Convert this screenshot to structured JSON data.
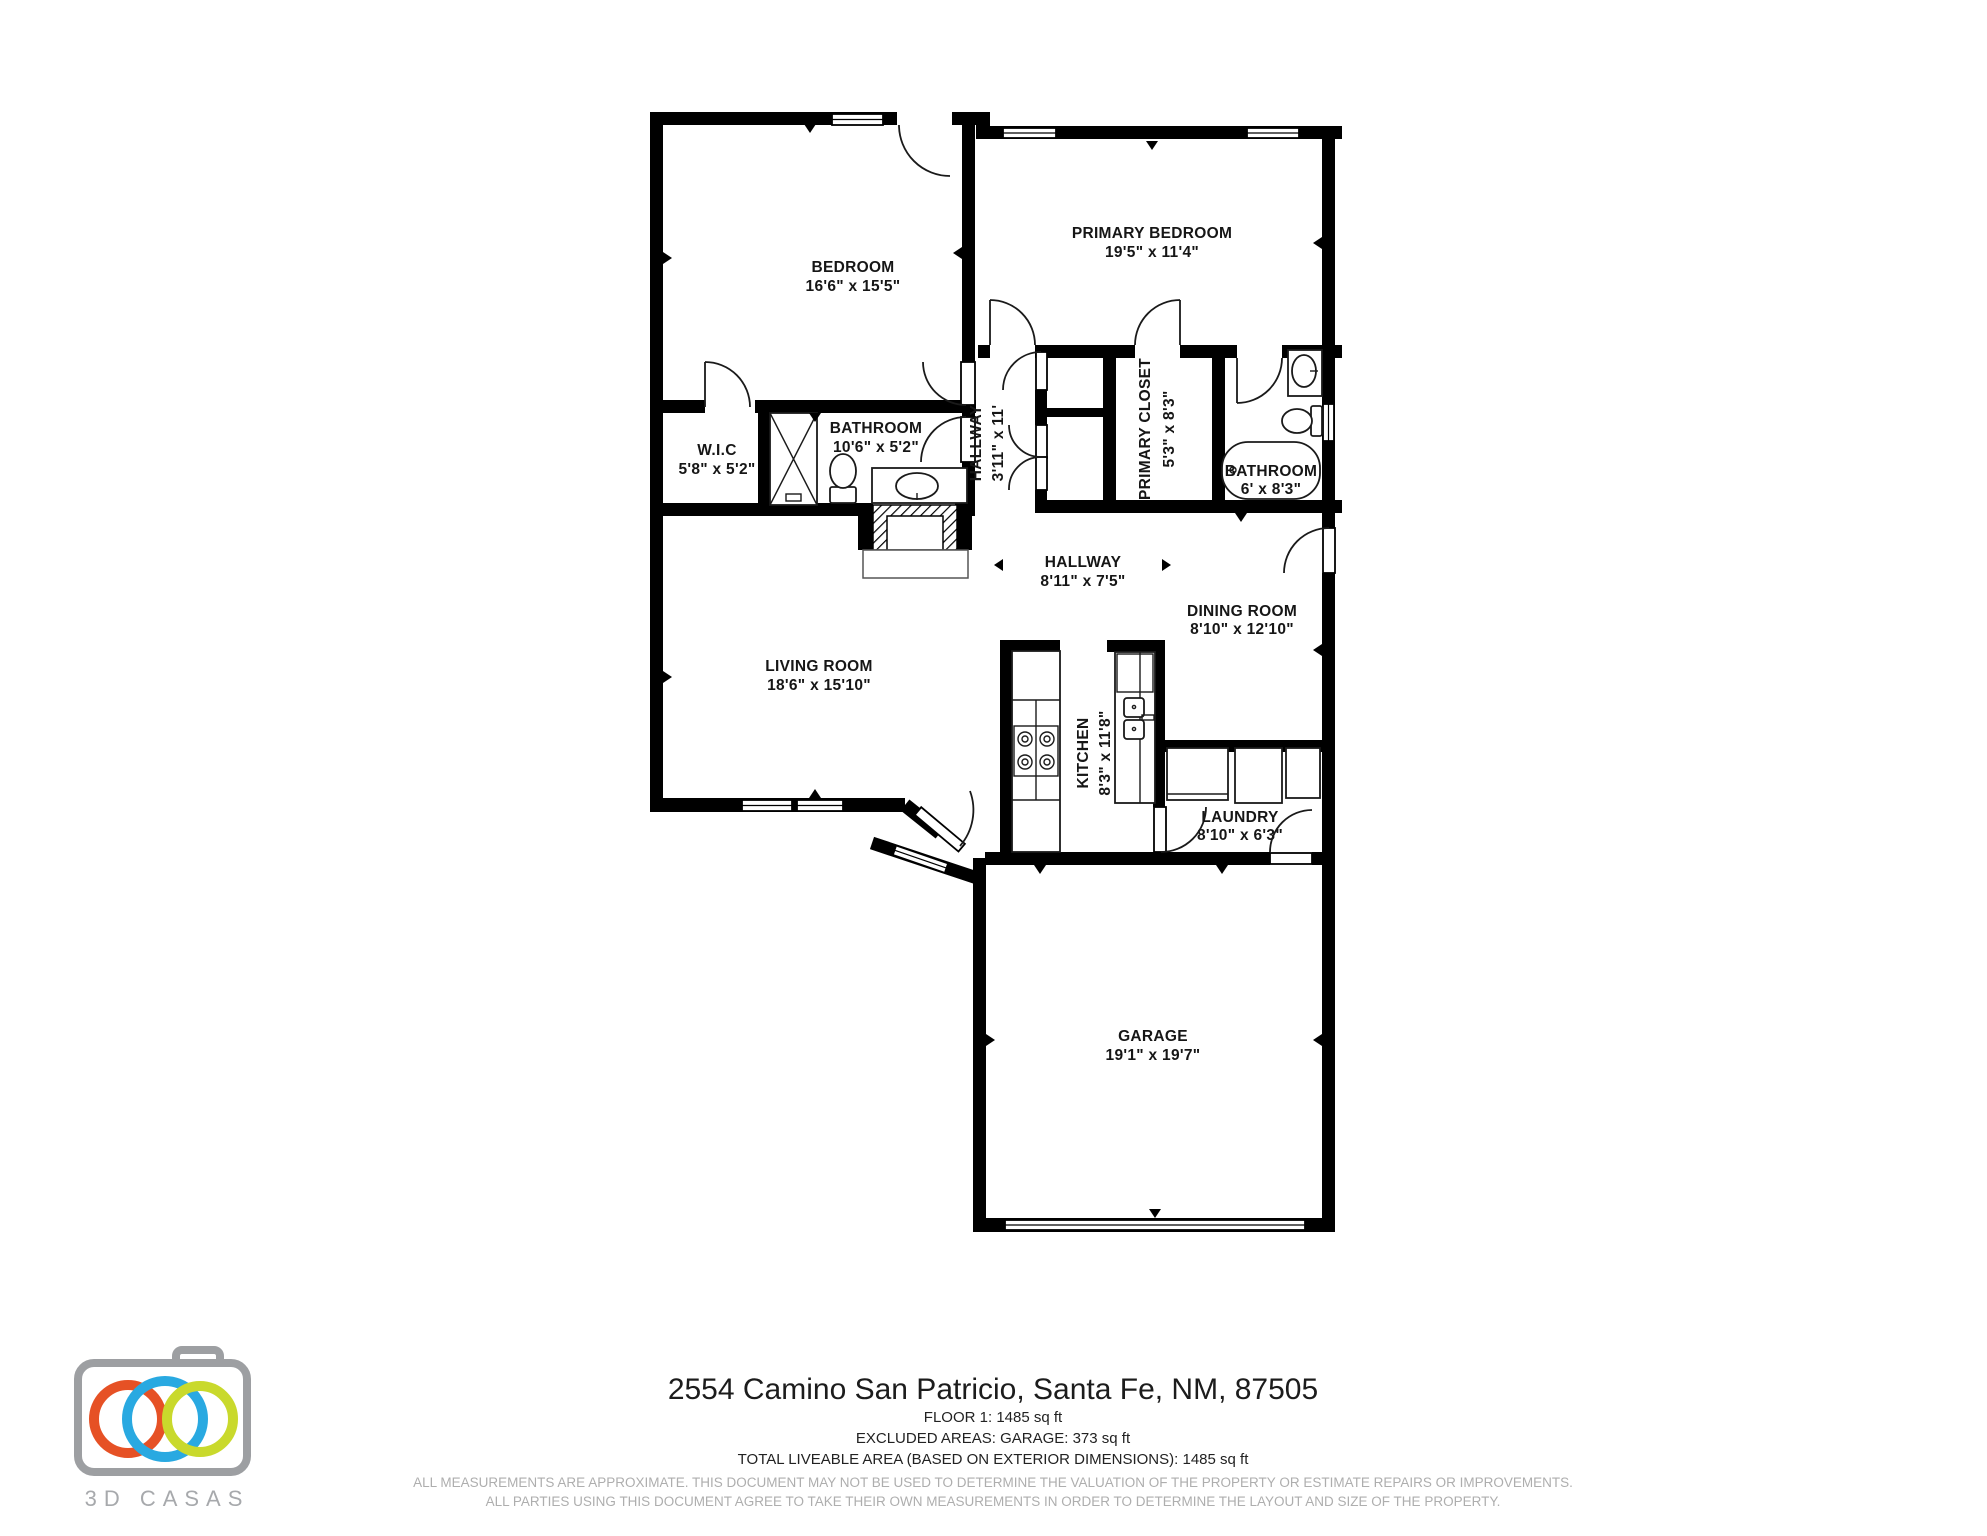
{
  "rooms": {
    "bedroom": {
      "name": "BEDROOM",
      "dims": "16'6\" x 15'5\""
    },
    "primary_bedroom": {
      "name": "PRIMARY BEDROOM",
      "dims": "19'5\" x 11'4\""
    },
    "bathroom": {
      "name": "BATHROOM",
      "dims": "10'6\" x 5'2\""
    },
    "wic": {
      "name": "W.I.C",
      "dims": "5'8\" x 5'2\""
    },
    "hallway_upper": {
      "name": "HALLWAY",
      "dims": "3'11\" x 11'"
    },
    "primary_closet": {
      "name": "PRIMARY CLOSET",
      "dims": "5'3\" x 8'3\""
    },
    "primary_bathroom": {
      "name": "BATHROOM",
      "dims": "6' x 8'3\""
    },
    "hallway_main": {
      "name": "HALLWAY",
      "dims": "8'11\" x 7'5\""
    },
    "dining_room": {
      "name": "DINING ROOM",
      "dims": "8'10\" x 12'10\""
    },
    "living_room": {
      "name": "LIVING ROOM",
      "dims": "18'6\" x 15'10\""
    },
    "kitchen": {
      "name": "KITCHEN",
      "dims": "8'3\" x 11'8\""
    },
    "laundry": {
      "name": "LAUNDRY",
      "dims": "8'10\" x 6'3\""
    },
    "garage": {
      "name": "GARAGE",
      "dims": "19'1\" x 19'7\""
    }
  },
  "footer": {
    "address": "2554 Camino San Patricio, Santa Fe, NM, 87505",
    "floor_area": "FLOOR 1: 1485 sq ft",
    "excluded_areas": "EXCLUDED AREAS: GARAGE: 373 sq ft",
    "total_area": "TOTAL LIVEABLE AREA (BASED ON EXTERIOR DIMENSIONS): 1485 sq ft",
    "disclaimer_line1": "ALL MEASUREMENTS ARE APPROXIMATE. THIS DOCUMENT MAY NOT BE USED TO DETERMINE THE VALUATION OF THE PROPERTY OR ESTIMATE REPAIRS OR IMPROVEMENTS.",
    "disclaimer_line2": "ALL PARTIES USING THIS DOCUMENT AGREE TO TAKE THEIR OWN MEASUREMENTS IN ORDER TO DETERMINE THE LAYOUT AND SIZE OF THE PROPERTY."
  },
  "logo": {
    "brand": "3D CASAS",
    "colors": {
      "orange": "#e65125",
      "blue": "#29a9e1",
      "green": "#c9d92c",
      "gray": "#9d9fa2",
      "text_gray": "#a7a9ac"
    }
  }
}
